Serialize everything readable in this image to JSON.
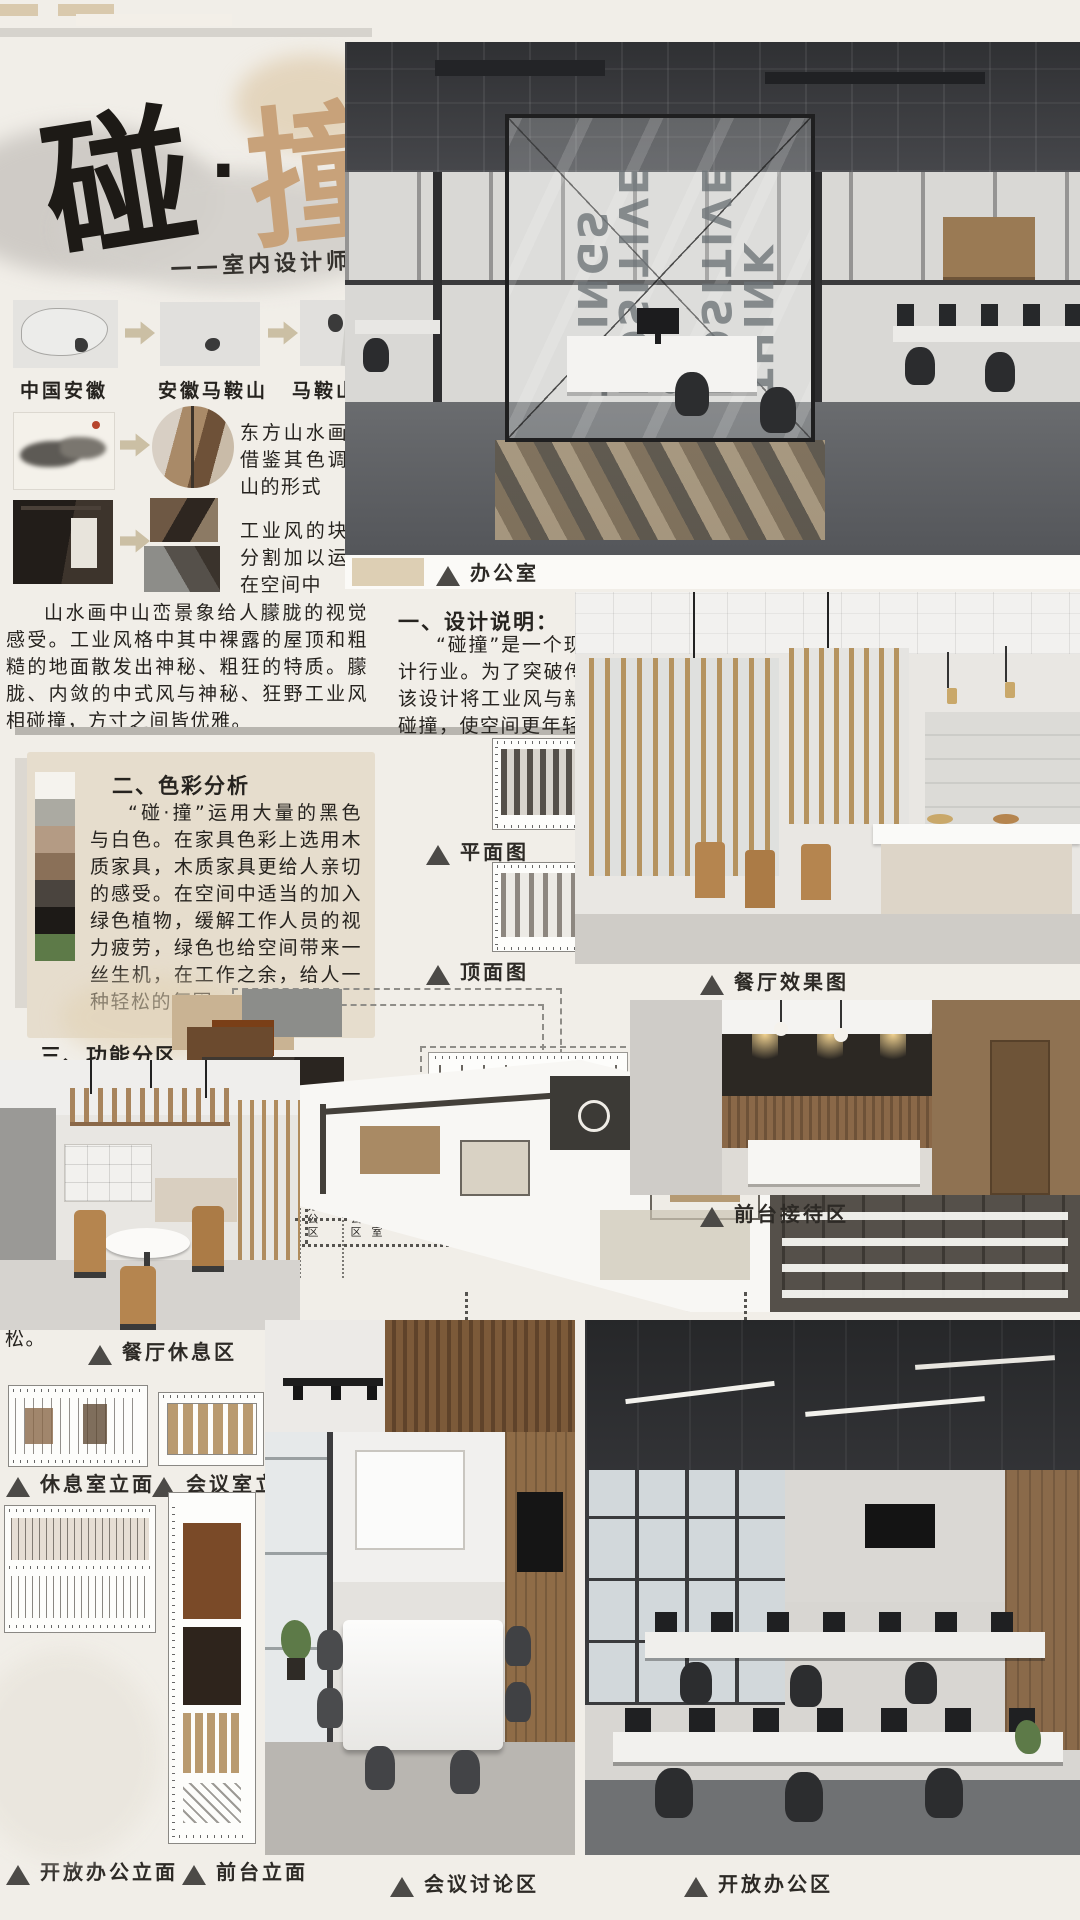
{
  "poster": {
    "title": {
      "main_black": "碰",
      "dot": "·",
      "main_tan": "撞",
      "subtitle": "——室内设计师工作室"
    },
    "maps": {
      "labels": [
        "中国安徽",
        "安徽马鞍山",
        "马鞍山雨山"
      ]
    },
    "concept": {
      "row1_text": "东方山水画，借鉴其色调与山的形式",
      "row2_text": "工业风的块状分割加以运行在空间中",
      "paragraph": "山水画中山峦景象给人朦胧的视觉感受。工业风格中其中裸露的屋顶和粗糙的地面散发出神秘、粗狂的特质。朦胧、内敛的中式风与神秘、狂野工业风相碰撞，方寸之间皆优雅。"
    },
    "office_photo": {
      "glass_text": "THINK POSITIVE & POSITIVE THINGS",
      "caption": "办公室"
    },
    "design_note": {
      "heading": "一、设计说明：",
      "body": "“碰撞”是一个现代办公空间，主要从事于室内设计行业。为了突破传统设计，加入新颖的设计元素，该设计将工业风与新中式风格相结合，工业与中式相碰撞，使空间更年轻化。"
    },
    "color_analysis": {
      "heading": "二、色彩分析",
      "body": "“碰·撞”运用大量的黑色与白色。在家具色彩上选用木质家具，木质家具更给人亲切的感受。在空间中适当的加入绿色植物，缓解工作人员的视力疲劳，绿色也给空间带来一丝生机，在工作之余，给人一种轻松的氛围。",
      "swatches": [
        "#f5f3ee",
        "#abaaa2",
        "#b49b84",
        "#8a7058",
        "#4a443e",
        "#1d1a17",
        "#5d7a48"
      ]
    },
    "plans": {
      "floor_caption": "平面图",
      "ceiling_caption": "顶面图"
    },
    "dining": {
      "caption": "餐厅效果图"
    },
    "zones": {
      "heading": "三、功能分区",
      "body": "将总裁办公室和大开放办公室设置在东边在顾客进入空间过程中设置展示区方便顾客了解该公司的基本情况,休息区比较远，目的为了员工能在此空间完全的放松。",
      "legend": [
        {
          "label": "清洁区",
          "color": "#ded3bf"
        },
        {
          "label": "娱乐休息区",
          "color": "#b29478"
        },
        {
          "label": "展示区",
          "color": "#9a7b5b"
        },
        {
          "label": "等候区",
          "color": "#7a5431"
        },
        {
          "label": "前台洽谈区",
          "color": "#8a4e1e"
        },
        {
          "label": "会议区",
          "color": "#6d4a2c"
        },
        {
          "label": "独立办公区",
          "color": "#4c3722"
        },
        {
          "label": "资料区",
          "color": "#3b322a"
        },
        {
          "label": "开放办公区",
          "color": "#332f2c"
        },
        {
          "label": "总裁办公室",
          "color": "#45413d"
        },
        {
          "label": "过道",
          "color": "#56524d"
        }
      ]
    },
    "reception": {
      "caption": "前台接待区"
    },
    "rest_area": {
      "caption": "餐厅休息区"
    },
    "elevations": {
      "rest_room": "休息室立面",
      "meeting_room": "会议室立面",
      "open_office": "开放办公立面",
      "front_desk": "前台立面"
    },
    "meeting_area": {
      "caption": "会议讨论区"
    },
    "open_office": {
      "caption": "开放办公区"
    }
  }
}
